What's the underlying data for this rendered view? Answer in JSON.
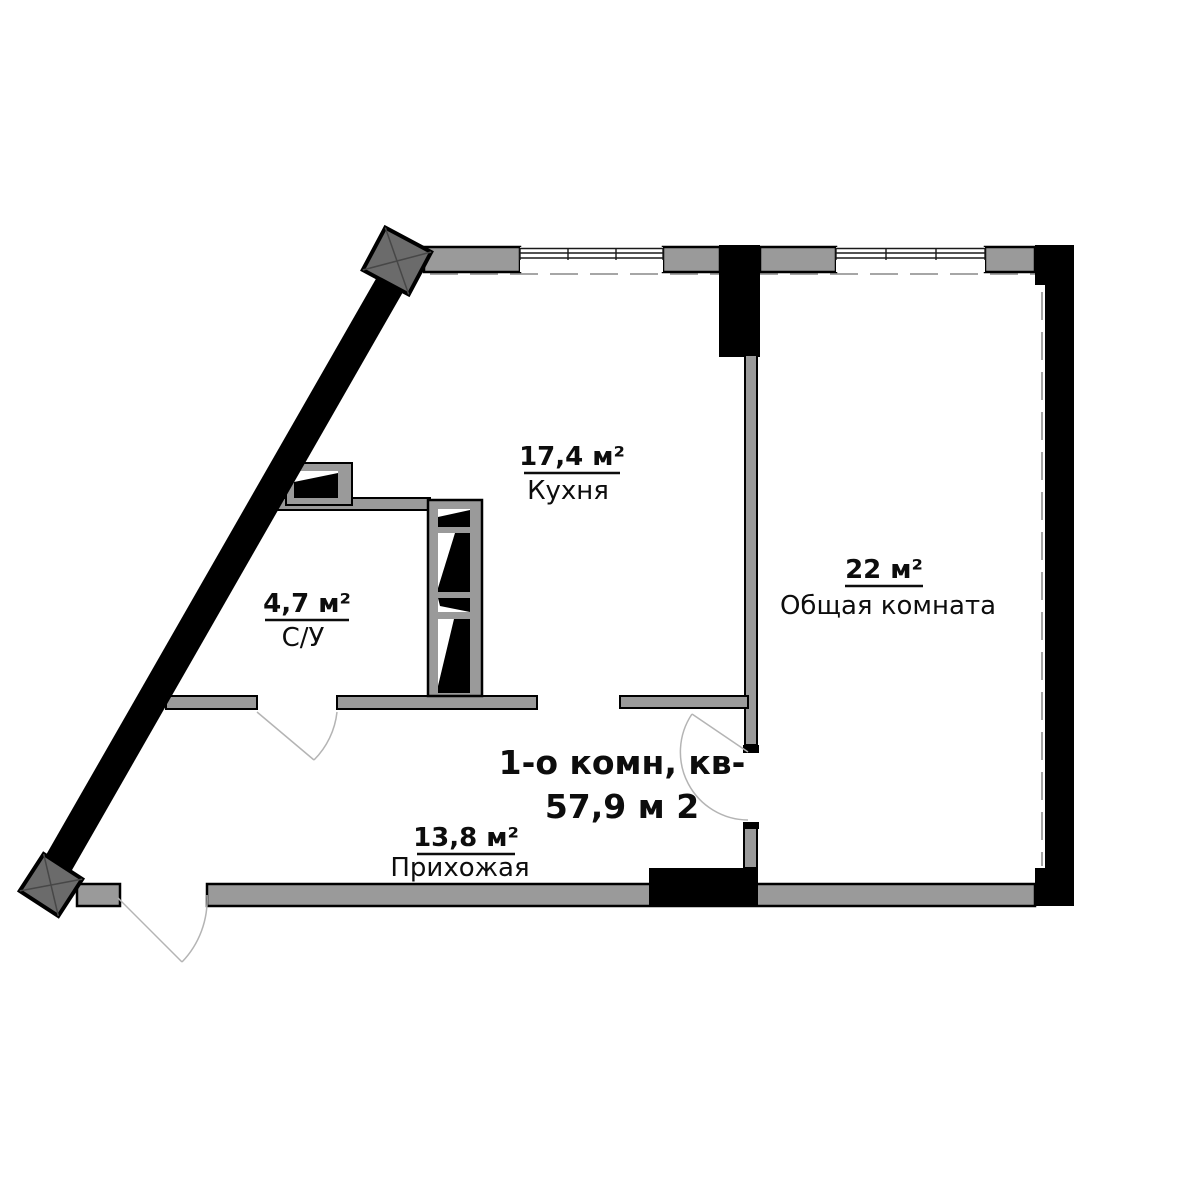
{
  "plan": {
    "title_line1": "1-о комн, кв-",
    "title_line2": "57,9 м 2"
  },
  "rooms": [
    {
      "name": "Кухня",
      "area": "17,4 м²"
    },
    {
      "name": "С/У",
      "area": "4,7 м²"
    },
    {
      "name": "Общая комната",
      "area": "22 м²"
    },
    {
      "name": "Прихожая",
      "area": "13,8 м²"
    }
  ],
  "colors": {
    "wall_gray": "#9a9a9a",
    "wall_black": "#000000",
    "column_gray": "#6b6b6b",
    "background": "#ffffff",
    "text": "#0d0d0d"
  }
}
